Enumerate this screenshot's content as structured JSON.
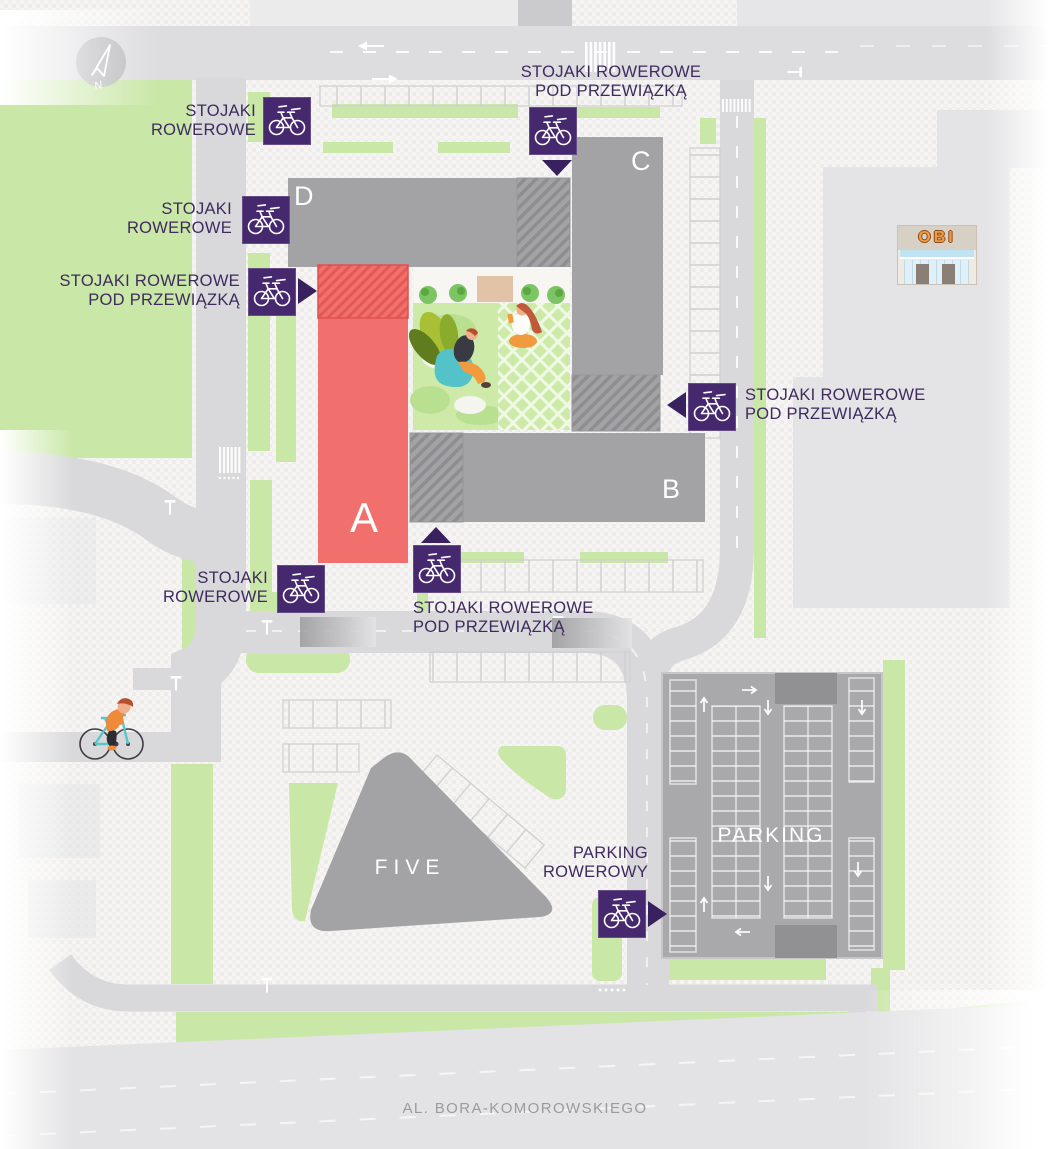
{
  "map": {
    "compass": {
      "label": "N"
    },
    "street": {
      "label": "AL. BORA-KOMOROWSKIEGO"
    },
    "obi": {
      "label": "OBI"
    },
    "buildings": {
      "a": {
        "label": "A"
      },
      "b": {
        "label": "B"
      },
      "c": {
        "label": "C"
      },
      "d": {
        "label": "D"
      },
      "five": {
        "label": "FIVE"
      },
      "parking": {
        "label": "PARKING"
      }
    },
    "markers": {
      "m1": {
        "line1": "STOJAKI",
        "line2": "ROWEROWE"
      },
      "m2": {
        "line1": "STOJAKI",
        "line2": "ROWEROWE"
      },
      "m3": {
        "line1": "STOJAKI ROWEROWE",
        "line2": "POD PRZEWIĄZKĄ"
      },
      "m4": {
        "line1": "STOJAKI ROWEROWE",
        "line2": "POD PRZEWIĄZKĄ"
      },
      "m5": {
        "line1": "STOJAKI ROWEROWE",
        "line2": "POD PRZEWIĄZKĄ"
      },
      "m6": {
        "line1": "STOJAKI",
        "line2": "ROWEROWE"
      },
      "m7": {
        "line1": "STOJAKI ROWEROWE",
        "line2": "POD PRZEWIĄZKĄ"
      },
      "m8": {
        "line1": "PARKING",
        "line2": "ROWEROWY"
      }
    },
    "colors": {
      "accent_purple": "#46286e",
      "arrow_purple": "#39215f",
      "label_purple": "#3f2a5e",
      "building_red": "#f1706d",
      "building_gray": "#a3a3a6",
      "green": "#c9e7a6",
      "road": "#d9d9db"
    }
  }
}
